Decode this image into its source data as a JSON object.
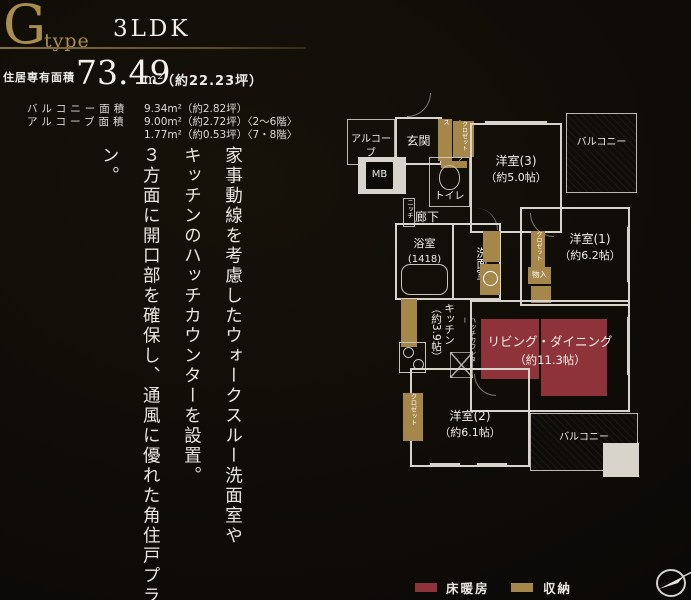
{
  "header": {
    "type_letter": "G",
    "type_word": "type",
    "layout": "3LDK"
  },
  "areas": {
    "main_label": "住居専有面積",
    "main_value": "73.49",
    "main_unit": "m²",
    "main_tsubo": "（約22.23坪）",
    "balcony_label": "バルコニー面積",
    "balcony_value": "9.34m²（約2.82坪）",
    "alcove_label": "アルコーブ面積",
    "alcove_value_1": "9.00m²（約2.72坪）〈2〜6階〉",
    "alcove_value_2": "1.77m²（約0.53坪）〈7・8階〉"
  },
  "copy_text": {
    "lines": [
      "家事動線を考慮したウォークスルー洗面室や",
      "キッチンのハッチカウンターを設置。",
      "３方面に開口部を確保し、通風に優れた角住戸プラン。"
    ]
  },
  "floorplan": {
    "labels": {
      "alcove": "アルコーブ",
      "entrance": "玄関",
      "mb": "MB",
      "shoe_box": "シューズボックス",
      "entrance_closet": "クロゼット",
      "toilet": "トイレ",
      "hallway": "廊下",
      "niche": "ニッチ",
      "bath": "浴室",
      "bath_size": "(1418)",
      "washroom": "洗面室",
      "western3": "洋室(3)",
      "western3_size": "（約5.0帖）",
      "western1": "洋室(1)",
      "western1_size": "（約6.2帖）",
      "western2": "洋室(2)",
      "western2_size": "（約6.1帖）",
      "living": "リビング・ダイニング",
      "living_size": "（約11.3帖）",
      "kitchen": "キッチン",
      "kitchen_size": "（約3.9帖）",
      "hatch_counter": "ハッチカウンター",
      "closet_w1": "クロゼット",
      "monoire": "物入",
      "closet_w2": "クロゼット",
      "balcony_top": "バルコニー",
      "balcony_bottom": "バルコニー"
    }
  },
  "legend": {
    "floor_heating": "床暖房",
    "storage": "収納"
  },
  "colors": {
    "accent_gold": "#a98e4d",
    "floor_heating": "#8e333a",
    "storage": "#a5874a",
    "wall": "#d8d4cc"
  }
}
